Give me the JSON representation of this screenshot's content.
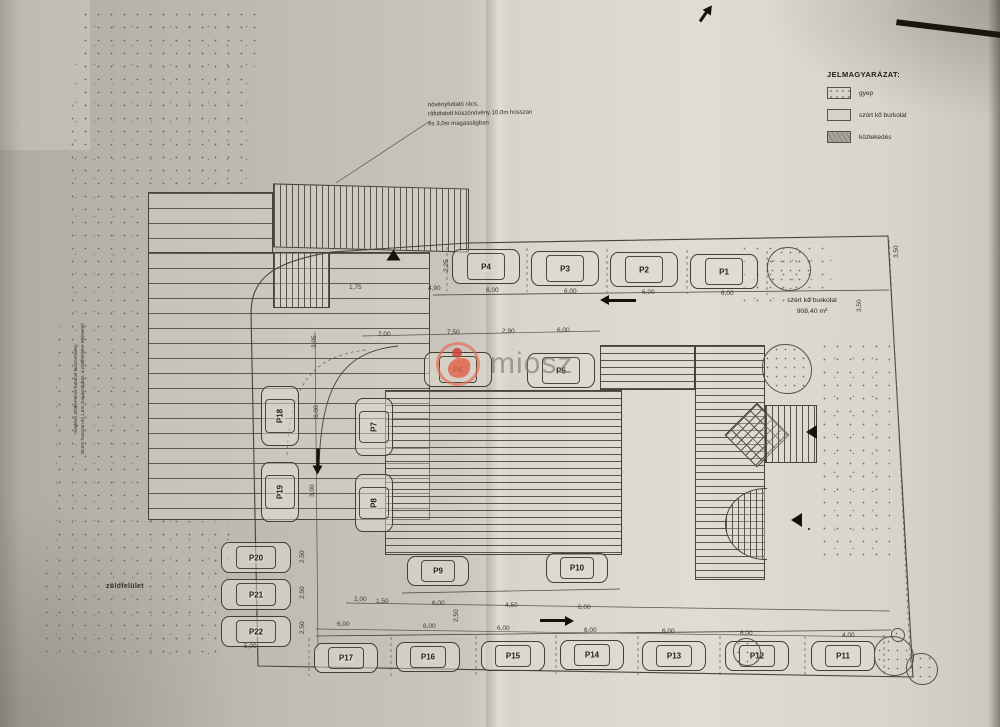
{
  "colors": {
    "paper": "#cfcbc2",
    "line": "#45433d",
    "watermark_red": "#e2674f",
    "watermark_gray": "#807e79"
  },
  "legend": {
    "title": "JELMAGYARÁZAT:",
    "items": [
      {
        "name": "gyep",
        "swatch": "dots"
      },
      {
        "name": "szórt kő burkolat",
        "swatch": "plain"
      },
      {
        "name": "közlekedés",
        "swatch": "gray"
      }
    ]
  },
  "annotations": {
    "top_note": "növényfuttató rács,\nráfuttatott kúszónövény 10,0m hosszan\nés 3,0m magasságban",
    "left_note": "meglévő drótkerítésre futtatott kúszónövény\n30,0m hosszan és 1,5m magasságban, a zöldfelületre tekintettel",
    "area_label": "szórt kő burkolat\n908,40 m²",
    "green_label": "zöldfelület"
  },
  "watermark": {
    "text": "miosz"
  },
  "site_plan": {
    "parking": [
      {
        "label": "P4",
        "x": 452,
        "y": 249,
        "w": 68,
        "h": 35,
        "v": 0
      },
      {
        "label": "P3",
        "x": 531,
        "y": 251,
        "w": 68,
        "h": 35,
        "v": 0
      },
      {
        "label": "P2",
        "x": 610,
        "y": 252,
        "w": 68,
        "h": 35,
        "v": 0
      },
      {
        "label": "P1",
        "x": 690,
        "y": 254,
        "w": 68,
        "h": 35,
        "v": 0
      },
      {
        "label": "P6",
        "x": 424,
        "y": 352,
        "w": 68,
        "h": 35,
        "v": 0
      },
      {
        "label": "P5",
        "x": 527,
        "y": 353,
        "w": 68,
        "h": 35,
        "v": 0
      },
      {
        "label": "P7",
        "x": 355,
        "y": 398,
        "w": 38,
        "h": 58,
        "v": 1
      },
      {
        "label": "P8",
        "x": 355,
        "y": 474,
        "w": 38,
        "h": 58,
        "v": 1
      },
      {
        "label": "P18",
        "x": 261,
        "y": 386,
        "w": 38,
        "h": 60,
        "v": 1
      },
      {
        "label": "P19",
        "x": 261,
        "y": 462,
        "w": 38,
        "h": 60,
        "v": 1
      },
      {
        "label": "P20",
        "x": 221,
        "y": 542,
        "w": 70,
        "h": 31,
        "v": 0
      },
      {
        "label": "P21",
        "x": 221,
        "y": 579,
        "w": 70,
        "h": 31,
        "v": 0
      },
      {
        "label": "P22",
        "x": 221,
        "y": 616,
        "w": 70,
        "h": 31,
        "v": 0
      },
      {
        "label": "P9",
        "x": 407,
        "y": 556,
        "w": 62,
        "h": 30,
        "v": 0
      },
      {
        "label": "P10",
        "x": 546,
        "y": 553,
        "w": 62,
        "h": 30,
        "v": 0
      },
      {
        "label": "P17",
        "x": 314,
        "y": 643,
        "w": 64,
        "h": 30,
        "v": 0
      },
      {
        "label": "P16",
        "x": 396,
        "y": 642,
        "w": 64,
        "h": 30,
        "v": 0
      },
      {
        "label": "P15",
        "x": 481,
        "y": 641,
        "w": 64,
        "h": 30,
        "v": 0
      },
      {
        "label": "P14",
        "x": 560,
        "y": 640,
        "w": 64,
        "h": 30,
        "v": 0
      },
      {
        "label": "P13",
        "x": 642,
        "y": 641,
        "w": 64,
        "h": 30,
        "v": 0
      },
      {
        "label": "P12",
        "x": 725,
        "y": 641,
        "w": 64,
        "h": 30,
        "v": 0
      },
      {
        "label": "P11",
        "x": 811,
        "y": 641,
        "w": 64,
        "h": 30,
        "v": 0
      }
    ],
    "dimensions": [
      {
        "t": "1,75",
        "x": 349,
        "y": 284,
        "r": 0
      },
      {
        "t": "4,90",
        "x": 428,
        "y": 285,
        "r": 0
      },
      {
        "t": "6,00",
        "x": 486,
        "y": 287,
        "r": 0
      },
      {
        "t": "6,00",
        "x": 564,
        "y": 288,
        "r": 0
      },
      {
        "t": "6,00",
        "x": 642,
        "y": 289,
        "r": 0
      },
      {
        "t": "6,00",
        "x": 721,
        "y": 290,
        "r": 0
      },
      {
        "t": "2,25",
        "x": 443,
        "y": 272,
        "r": 1
      },
      {
        "t": "3,50",
        "x": 856,
        "y": 312,
        "r": 1
      },
      {
        "t": "3,50",
        "x": 893,
        "y": 258,
        "r": 1
      },
      {
        "t": "2,00",
        "x": 378,
        "y": 331,
        "r": 0
      },
      {
        "t": "7,50",
        "x": 447,
        "y": 329,
        "r": 0
      },
      {
        "t": "2,90",
        "x": 502,
        "y": 328,
        "r": 0
      },
      {
        "t": "6,00",
        "x": 557,
        "y": 327,
        "r": 0
      },
      {
        "t": "3,05",
        "x": 311,
        "y": 348,
        "r": 1
      },
      {
        "t": "6,00",
        "x": 313,
        "y": 418,
        "r": 1
      },
      {
        "t": "3,00",
        "x": 309,
        "y": 497,
        "r": 1
      },
      {
        "t": "2,50",
        "x": 299,
        "y": 563,
        "r": 1
      },
      {
        "t": "2,50",
        "x": 299,
        "y": 599,
        "r": 1
      },
      {
        "t": "2,50",
        "x": 299,
        "y": 634,
        "r": 1
      },
      {
        "t": "5,00",
        "x": 244,
        "y": 643,
        "r": 0
      },
      {
        "t": "2,00",
        "x": 354,
        "y": 596,
        "r": 0
      },
      {
        "t": "1,50",
        "x": 376,
        "y": 598,
        "r": 0
      },
      {
        "t": "6,00",
        "x": 432,
        "y": 600,
        "r": 0
      },
      {
        "t": "4,50",
        "x": 505,
        "y": 602,
        "r": 0
      },
      {
        "t": "6,00",
        "x": 578,
        "y": 604,
        "r": 0
      },
      {
        "t": "2,50",
        "x": 453,
        "y": 622,
        "r": 1
      },
      {
        "t": "6,00",
        "x": 337,
        "y": 621,
        "r": 0
      },
      {
        "t": "6,00",
        "x": 423,
        "y": 623,
        "r": 0
      },
      {
        "t": "6,00",
        "x": 497,
        "y": 625,
        "r": 0
      },
      {
        "t": "6,00",
        "x": 584,
        "y": 627,
        "r": 0
      },
      {
        "t": "6,00",
        "x": 662,
        "y": 628,
        "r": 0
      },
      {
        "t": "6,00",
        "x": 740,
        "y": 630,
        "r": 0
      },
      {
        "t": "4,00",
        "x": 842,
        "y": 632,
        "r": 0
      }
    ],
    "trees": [
      {
        "x": 788,
        "y": 268,
        "r": 21
      },
      {
        "x": 786,
        "y": 368,
        "r": 24
      },
      {
        "x": 746,
        "y": 651,
        "r": 13
      },
      {
        "x": 893,
        "y": 655,
        "r": 19
      },
      {
        "x": 921,
        "y": 668,
        "r": 15
      },
      {
        "x": 897,
        "y": 634,
        "r": 6
      }
    ],
    "arrows": [
      {
        "k": "a",
        "x": 636,
        "y": 299,
        "len": 28,
        "rot": 180
      },
      {
        "k": "a",
        "x": 318,
        "y": 447,
        "len": 18,
        "rot": 90
      },
      {
        "k": "a",
        "x": 540,
        "y": 619,
        "len": 26,
        "rot": 0
      },
      {
        "k": "a",
        "x": 700,
        "y": 20,
        "len": 12,
        "rot": -55
      },
      {
        "k": "t",
        "x": 806,
        "y": 425,
        "rot": 0
      },
      {
        "k": "t",
        "x": 791,
        "y": 513,
        "rot": 0
      },
      {
        "k": "t",
        "x": 388,
        "y": 248,
        "rot": 90
      }
    ]
  }
}
